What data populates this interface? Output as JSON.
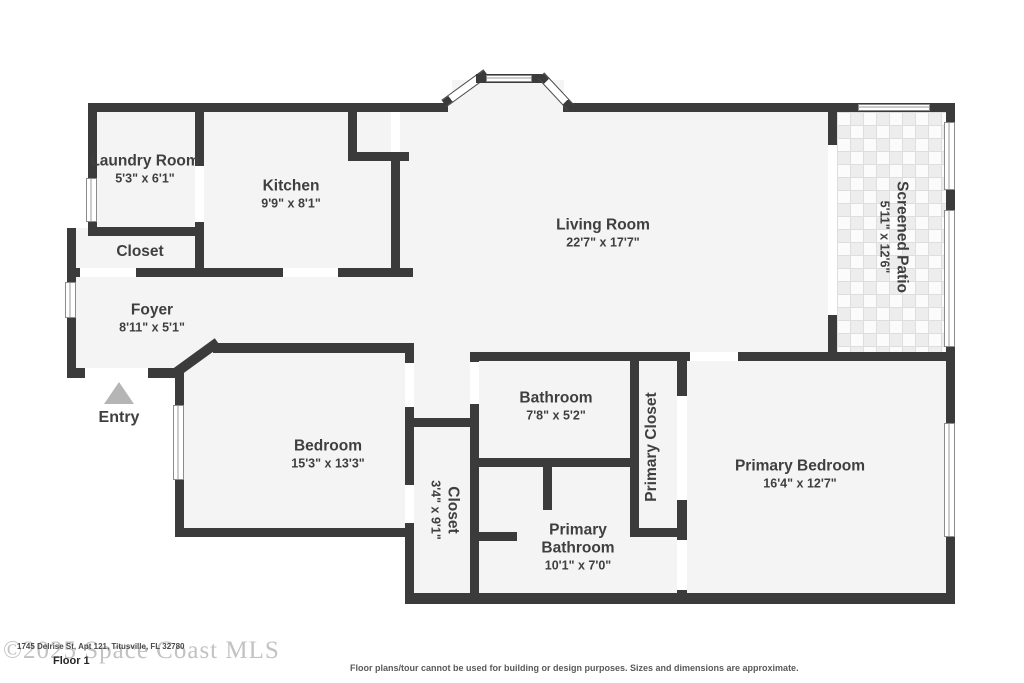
{
  "plan": {
    "rooms": {
      "laundry": {
        "name": "Laundry Room",
        "dims": "5'3\" x 6'1\""
      },
      "kitchen": {
        "name": "Kitchen",
        "dims": "9'9\" x 8'1\""
      },
      "living": {
        "name": "Living Room",
        "dims": "22'7\" x 17'7\""
      },
      "patio": {
        "name": "Screened Patio",
        "dims": "5'11\" x 12'6\""
      },
      "closet_hall": {
        "name": "Closet"
      },
      "foyer": {
        "name": "Foyer",
        "dims": "8'11\" x 5'1\""
      },
      "bedroom": {
        "name": "Bedroom",
        "dims": "15'3\" x 13'3\""
      },
      "bathroom": {
        "name": "Bathroom",
        "dims": "7'8\" x 5'2\""
      },
      "primary_closet": {
        "name": "Primary Closet"
      },
      "closet_corridor": {
        "name": "Closet",
        "dims": "3'4\" x 9'1\""
      },
      "primary_bathroom": {
        "name": "Primary Bathroom",
        "dims": "10'1\" x 7'0\""
      },
      "primary_bedroom": {
        "name": "Primary Bedroom",
        "dims": "16'4\" x 12'7\""
      }
    },
    "entry_label": "Entry",
    "colors": {
      "wall": "#3b3b3b",
      "room_fill": "#f4f4f4",
      "entry_arrow": "#b5b5b5",
      "label_text": "#3f3f3f"
    }
  },
  "footer": {
    "watermark": "©2025 Space Coast MLS",
    "address": "1745 Delrise St, Apt 121, Titusville, FL 32780",
    "floor_label": "Floor 1",
    "disclaimer": "Floor plans/tour cannot be used for building or design purposes. Sizes and dimensions are approximate."
  }
}
